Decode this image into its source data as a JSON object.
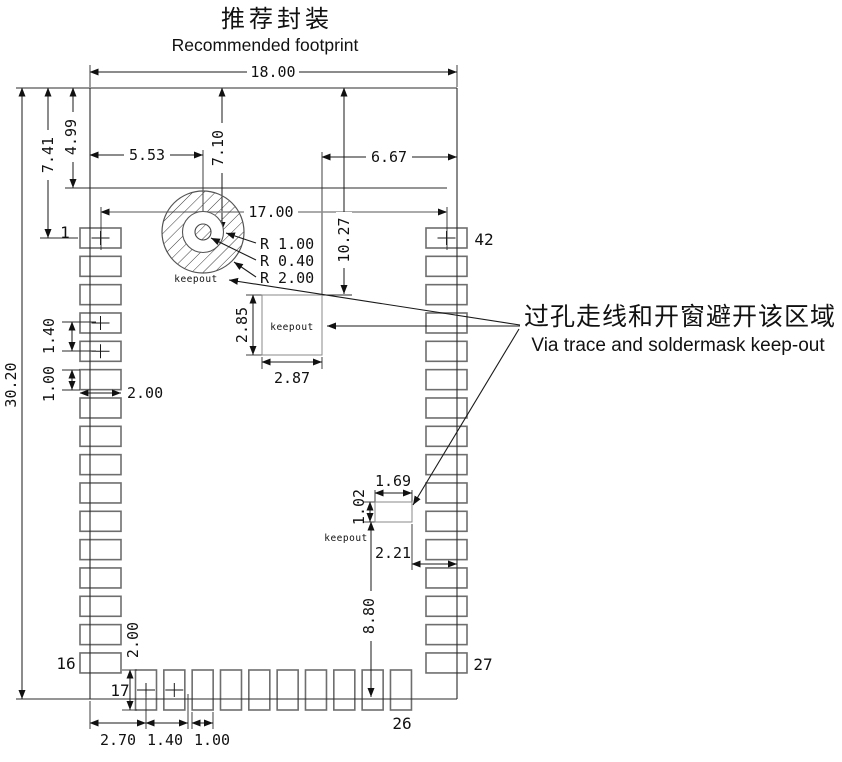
{
  "title": {
    "zh": "推荐封装",
    "en": "Recommended footprint"
  },
  "callout": {
    "zh": "过孔走线和开窗避开该区域",
    "en": "Via trace and soldermask keep-out"
  },
  "keepout_label": "keepout",
  "pins": {
    "p1": "1",
    "p16": "16",
    "p17": "17",
    "p26": "26",
    "p27": "27",
    "p42": "42"
  },
  "dims": {
    "overall_w": "18.00",
    "overall_h": "30.20",
    "top_to_pin1": "7.41",
    "top_to_antenna_line": "4.99",
    "via_offset_x": "5.53",
    "via_offset_y": "7.10",
    "keepout_to_right_edge": "6.67",
    "pad_row_span": "17.00",
    "top_to_center_keepout": "10.27",
    "center_keepout_h": "2.85",
    "center_keepout_w": "2.87",
    "side_pad_pitch": "1.40",
    "side_pad_h": "1.00",
    "side_pad_w": "2.00",
    "via_pad_radius": "R 1.00",
    "via_hole_radius": "R 0.40",
    "via_keepout_radius": "R 2.00",
    "small_keepout_w": "1.69",
    "small_keepout_h": "1.02",
    "small_keepout_to_edge": "2.21",
    "small_keepout_to_bottom": "8.80",
    "bottom_pad_h": "2.00",
    "edge_to_first_bottom_pad": "2.70",
    "bottom_pad_pitch": "1.40",
    "bottom_pad_w": "1.00"
  },
  "colors": {
    "line": "#1a1a1a",
    "pad_stroke": "#6e6e6e",
    "gray_dim": "#8d8d8d"
  }
}
